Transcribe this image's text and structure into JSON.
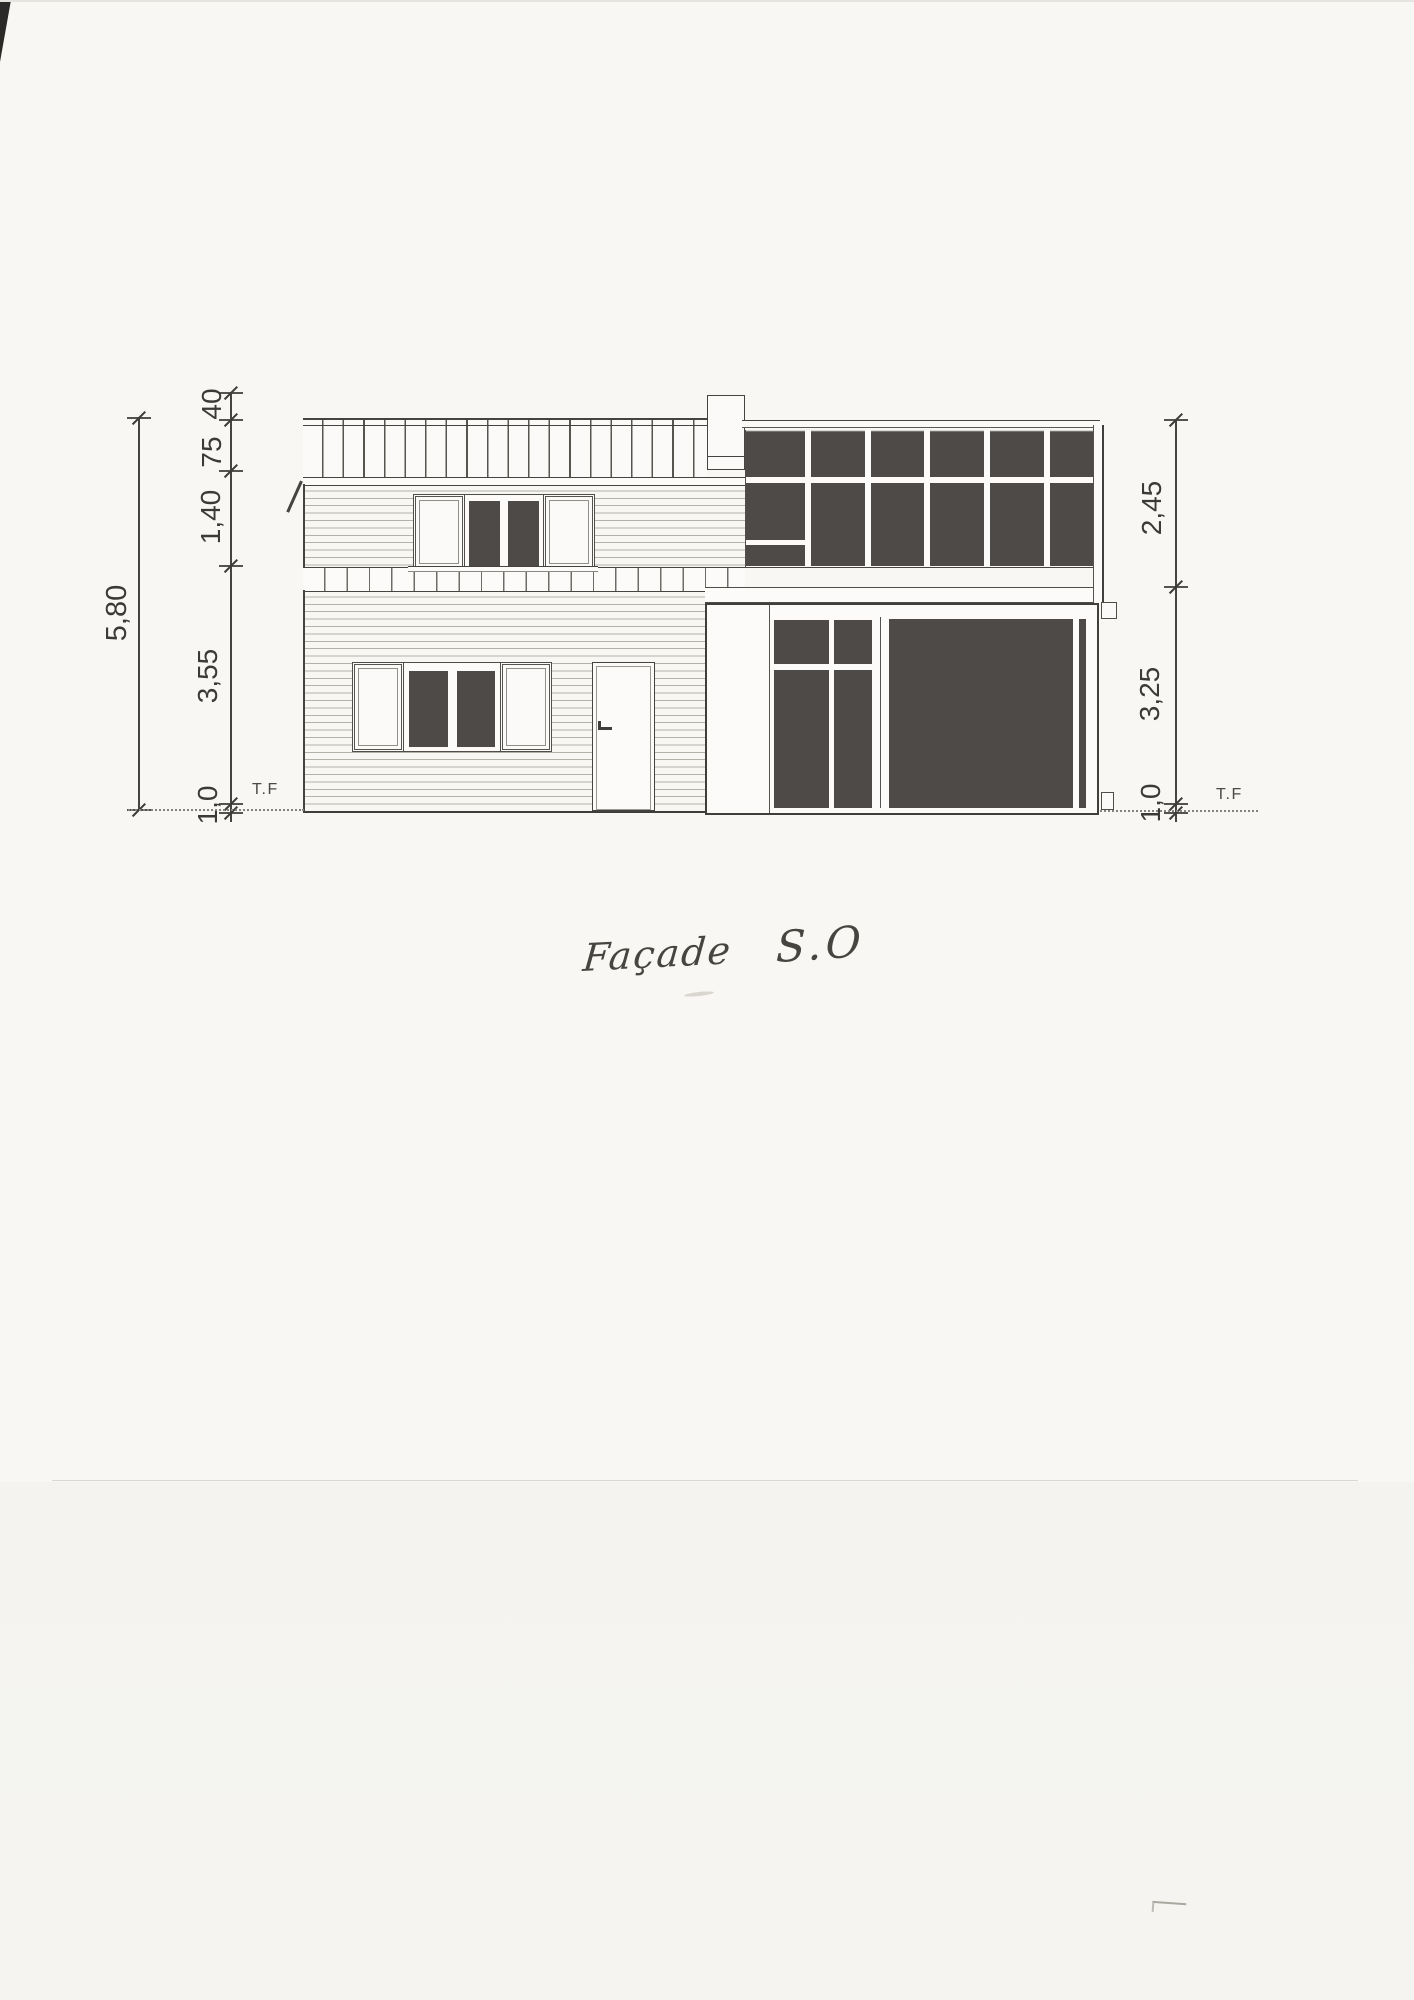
{
  "title": {
    "word1": "Façade",
    "word2": "S.O"
  },
  "dimensions": {
    "left_outer": "5,80",
    "left_chain": [
      "40",
      "75",
      "1,40",
      "3,55",
      "1,0"
    ],
    "right_chain": [
      "2,45",
      "3,25",
      "1,0"
    ],
    "ground_left": "T.F",
    "ground_right": "T.F"
  },
  "colors": {
    "paper": "#f8f7f4",
    "ink": "#454440",
    "glass": "#4e4a48",
    "siding_line": "#b4b1aa"
  }
}
